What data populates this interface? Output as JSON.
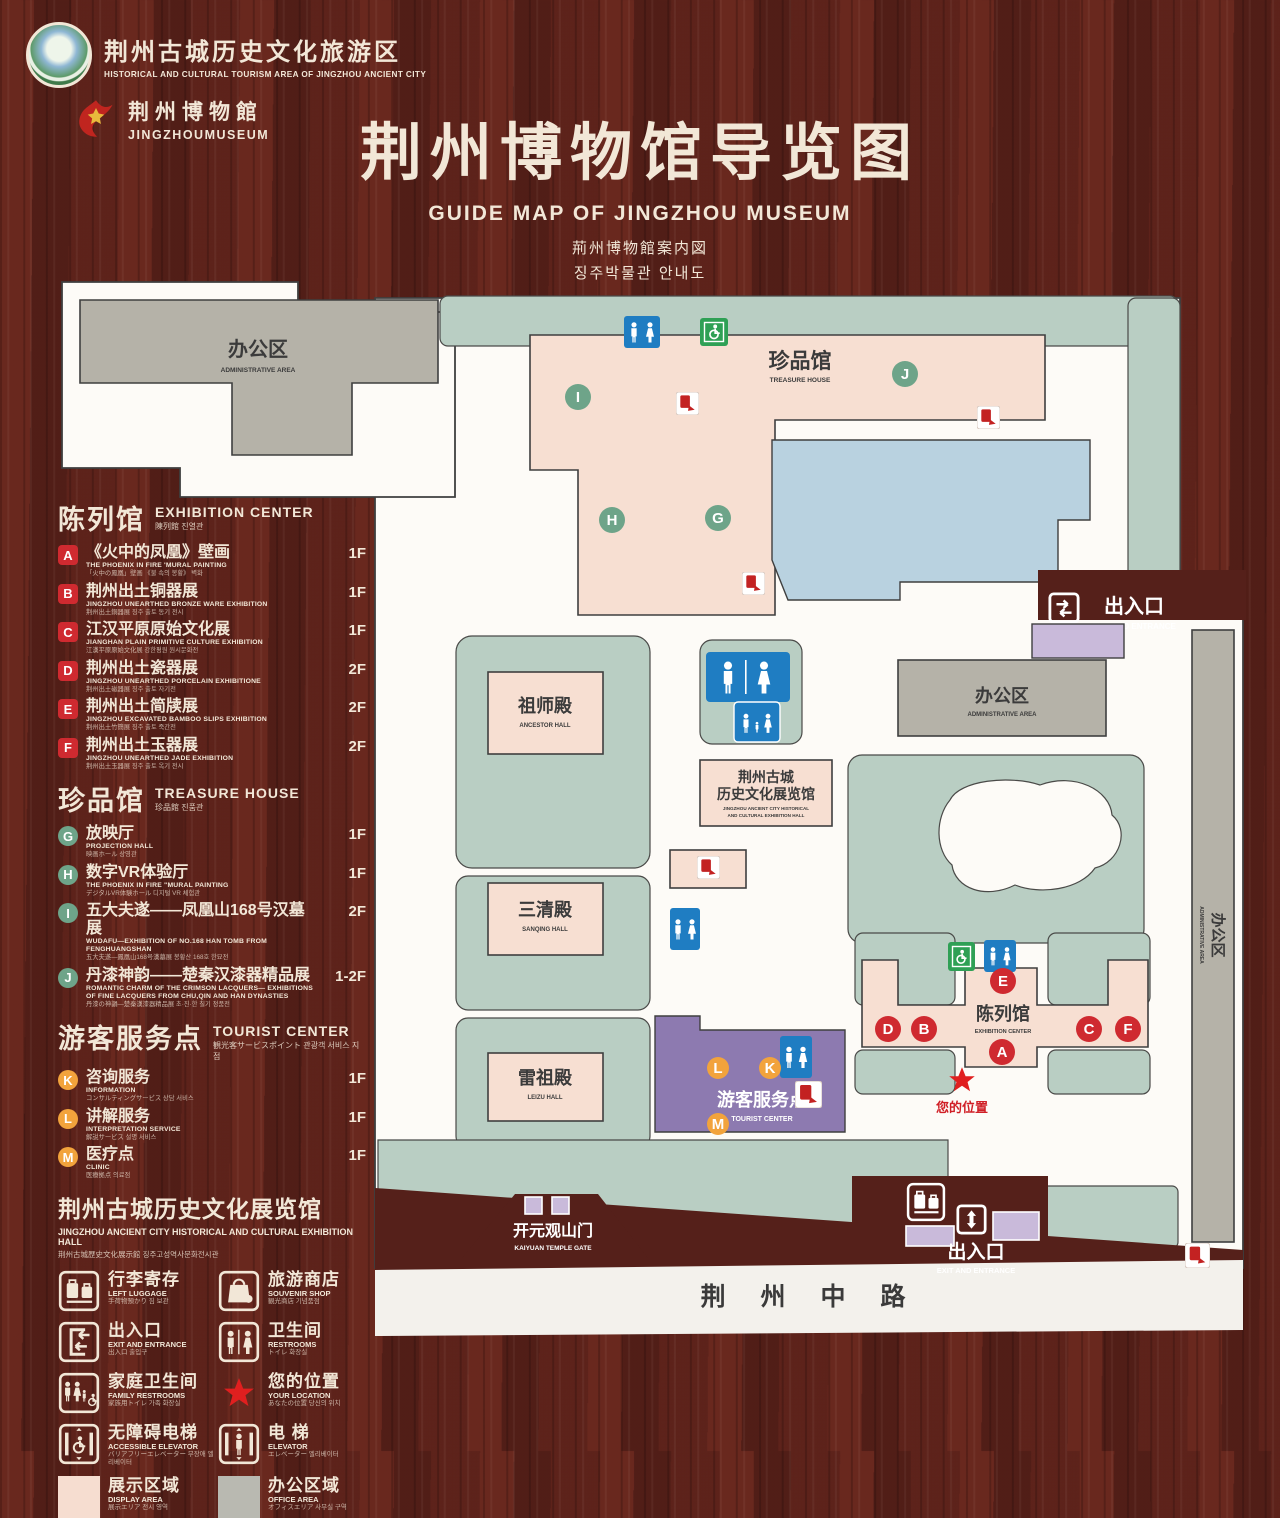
{
  "header": {
    "logo1": {
      "line1": "荆州古城历史文化旅游区",
      "line2": "HISTORICAL AND CULTURAL TOURISM AREA OF JINGZHOU ANCIENT CITY"
    },
    "logo2": {
      "line1": "荆州博物館",
      "line2": "JINGZHOUMUSEUM"
    },
    "title": "荆州博物馆导览图",
    "subtitle_en": "GUIDE MAP OF JINGZHOU MUSEUM",
    "subtitle_ja": "荊州博物館案内図",
    "subtitle_ko": "징주박물관 안내도"
  },
  "sidebar": {
    "sections": [
      {
        "title_zh": "陈列馆",
        "title_en": "EXHIBITION CENTER",
        "title_sub": "陳列館  진열관",
        "items": [
          {
            "letter": "A",
            "zh": "《火中的凤凰》壁画",
            "en": "THE PHOENIX IN FIRE 'MURAL PAINTING",
            "sub": "「火中の鳳凰」壁画 《불 속의 봉황》 벽화",
            "floor": "1F"
          },
          {
            "letter": "B",
            "zh": "荆州出土铜器展",
            "en": "JINGZHOU UNEARTHED BRONZE WARE EXHIBITION",
            "sub": "荆州出土銅器展  징주 출토 동기 전시",
            "floor": "1F"
          },
          {
            "letter": "C",
            "zh": "江汉平原原始文化展",
            "en": "JIANGHAN PLAIN PRIMITIVE CULTURE EXHIBITION",
            "sub": "江漢平原原始文化展  강한평원 원시문화전",
            "floor": "1F"
          },
          {
            "letter": "D",
            "zh": "荆州出土瓷器展",
            "en": "JINGZHOU UNEARTHED PORCELAIN EXHIBITIONE",
            "sub": "荆州出土磁器展  징주 출토 자기전",
            "floor": "2F"
          },
          {
            "letter": "E",
            "zh": "荆州出土简牍展",
            "en": "JINGZHOU EXCAVATED BAMBOO SLIPS EXHIBITION",
            "sub": "荆州出土竹簡展  징주 출토 죽간전",
            "floor": "2F"
          },
          {
            "letter": "F",
            "zh": "荆州出土玉器展",
            "en": "JINGZHOU UNEARTHED JADE EXHIBITION",
            "sub": "荆州出土玉器展  징주 출토 옥기 전시",
            "floor": "2F"
          }
        ]
      },
      {
        "title_zh": "珍品馆",
        "title_en": "TREASURE HOUSE",
        "title_sub": "珍品館  진품관",
        "items": [
          {
            "letter": "G",
            "zh": "放映厅",
            "en": "PROJECTION HALL",
            "sub": "映画ホール  상영관",
            "floor": "1F"
          },
          {
            "letter": "H",
            "zh": "数字VR体验厅",
            "en": "THE PHOENIX IN FIRE \"MURAL PAINTING",
            "sub": "デジタルVR体験ホール  디지털 VR 체험관",
            "floor": "1F"
          },
          {
            "letter": "I",
            "zh": "五大夫遂——凤凰山168号汉墓展",
            "en": "WUDAFU—EXHIBITION OF NO.168 HAN TOMB FROM FENGHUANGSHAN",
            "sub": "五大夫遂—鳳凰山168号漢墓展  봉황산 168호 한묘전",
            "floor": "2F"
          },
          {
            "letter": "J",
            "zh": "丹漆神韵——楚秦汉漆器精品展",
            "en": "ROMANTIC CHARM OF THE CRIMSON LACQUERS— EXHIBITIONS OF FINE LACQUERS FROM CHU,QIN AND HAN DYNASTIES",
            "sub": "丹漆の神韻—楚秦漢漆器精品展  초·진·한 칠기 정품전",
            "floor": "1-2F"
          }
        ]
      },
      {
        "title_zh": "游客服务点",
        "title_en": "TOURIST CENTER",
        "title_sub": "観光客サービスポイント  관광객 서비스 지점",
        "items": [
          {
            "letter": "K",
            "zh": "咨询服务",
            "en": "INFORMATION",
            "sub": "コンサルティングサービス  상담 서비스",
            "floor": "1F"
          },
          {
            "letter": "L",
            "zh": "讲解服务",
            "en": "INTERPRETATION SERVICE",
            "sub": "解説サービス  설명 서비스",
            "floor": "1F"
          },
          {
            "letter": "M",
            "zh": "医疗点",
            "en": "CLINIC",
            "sub": "医療拠点  의료점",
            "floor": "1F"
          }
        ]
      }
    ],
    "hall_note": {
      "zh": "荆州古城历史文化展览馆",
      "en": "JINGZHOU ANCIENT CITY HISTORICAL AND CULTURAL EXHIBITION HALL",
      "sub": "荆州古城歴史文化展示館   징주고성역사문화전시관"
    },
    "legend": [
      {
        "zh": "行李寄存",
        "en": "LEFT LUGGAGE",
        "sub": "手荷物預かり  짐 보관"
      },
      {
        "zh": "旅游商店",
        "en": "SOUVENIR SHOP",
        "sub": "観光商店  기념품점"
      },
      {
        "zh": "出入口",
        "en": "EXIT AND ENTRANCE",
        "sub": "出入口  출입구"
      },
      {
        "zh": "卫生间",
        "en": "RESTROOMS",
        "sub": "トイレ  화장실"
      },
      {
        "zh": "家庭卫生间",
        "en": "FAMILY RESTROOMS",
        "sub": "家族用トイレ  가족 화장실"
      },
      {
        "zh": "您的位置",
        "en": "YOUR LOCATION",
        "sub": "あなたの位置  당신의 위치"
      },
      {
        "zh": "无障碍电梯",
        "en": "ACCESSIBLE ELEVATOR",
        "sub": "バリアフリーエレベーター  무장애 엘리베이터"
      },
      {
        "zh": "电  梯",
        "en": "ELEVATOR",
        "sub": "エレベーター  엘리베이터"
      },
      {
        "zh": "展示区域",
        "en": "DISPLAY AREA",
        "sub": "展示エリア  전시 영역"
      },
      {
        "zh": "办公区域",
        "en": "OFFICE AREA",
        "sub": "オフィスエリア  사무실 구역"
      }
    ]
  },
  "map": {
    "labels": {
      "admin_top": {
        "zh": "办公区",
        "en": "ADMINISTRATIVE AREA"
      },
      "treasure": {
        "zh": "珍品馆",
        "en": "TREASURE HOUSE"
      },
      "exit_top": {
        "zh": "出入口",
        "en": "EXIT AND ENTRANCE"
      },
      "admin_right": {
        "zh": "办公区",
        "en": "ADMINISTRATIVE AREA"
      },
      "admin_side": {
        "zh": "办公区",
        "en": "ADMINISTRATIVE AREA"
      },
      "ancestor": {
        "zh": "祖师殿",
        "en": "ANCESTOR HALL"
      },
      "sanqing": {
        "zh": "三清殿",
        "en": "SANQING HALL"
      },
      "leizu": {
        "zh": "雷祖殿",
        "en": "LEIZU HALL"
      },
      "exhall": {
        "zh1": "荆州古城",
        "zh2": "历史文化展览馆",
        "en1": "JINGZHOU ANCIENT CITY HISTORICAL",
        "en2": "AND CULTURAL EXHIBITION HALL"
      },
      "tourist": {
        "zh": "游客服务点",
        "en": "TOURIST CENTER"
      },
      "excenter": {
        "zh": "陈列馆",
        "en": "EXHIBITION CENTER"
      },
      "your_location": {
        "zh": "您的位置"
      },
      "temple": {
        "zh": "开元观山门",
        "en": "KAIYUAN TEMPLE GATE"
      },
      "exit_bottom": {
        "zh": "出入口",
        "en": "EXIT AND ENTRANCE"
      },
      "road": {
        "zh": "荆 州 中 路"
      }
    },
    "badges": [
      {
        "letter": "I"
      },
      {
        "letter": "J"
      },
      {
        "letter": "H"
      },
      {
        "letter": "G"
      },
      {
        "letter": "E"
      },
      {
        "letter": "D"
      },
      {
        "letter": "B"
      },
      {
        "letter": "C"
      },
      {
        "letter": "F"
      },
      {
        "letter": "A"
      },
      {
        "letter": "L"
      },
      {
        "letter": "K"
      },
      {
        "letter": "M"
      }
    ]
  },
  "colors": {
    "display_area": "#f7dfd2",
    "office_area": "#b5b2a8",
    "lawn": "#b9cec3",
    "pond": "#b9d2e0",
    "tourist_purple": "#8d7ab0",
    "badge_red": "#cf2a30",
    "badge_green": "#6ea489",
    "badge_orange": "#f2a33c",
    "icon_blue": "#1f7dc2",
    "icon_green": "#2fa055",
    "star_red": "#e01f1f"
  }
}
